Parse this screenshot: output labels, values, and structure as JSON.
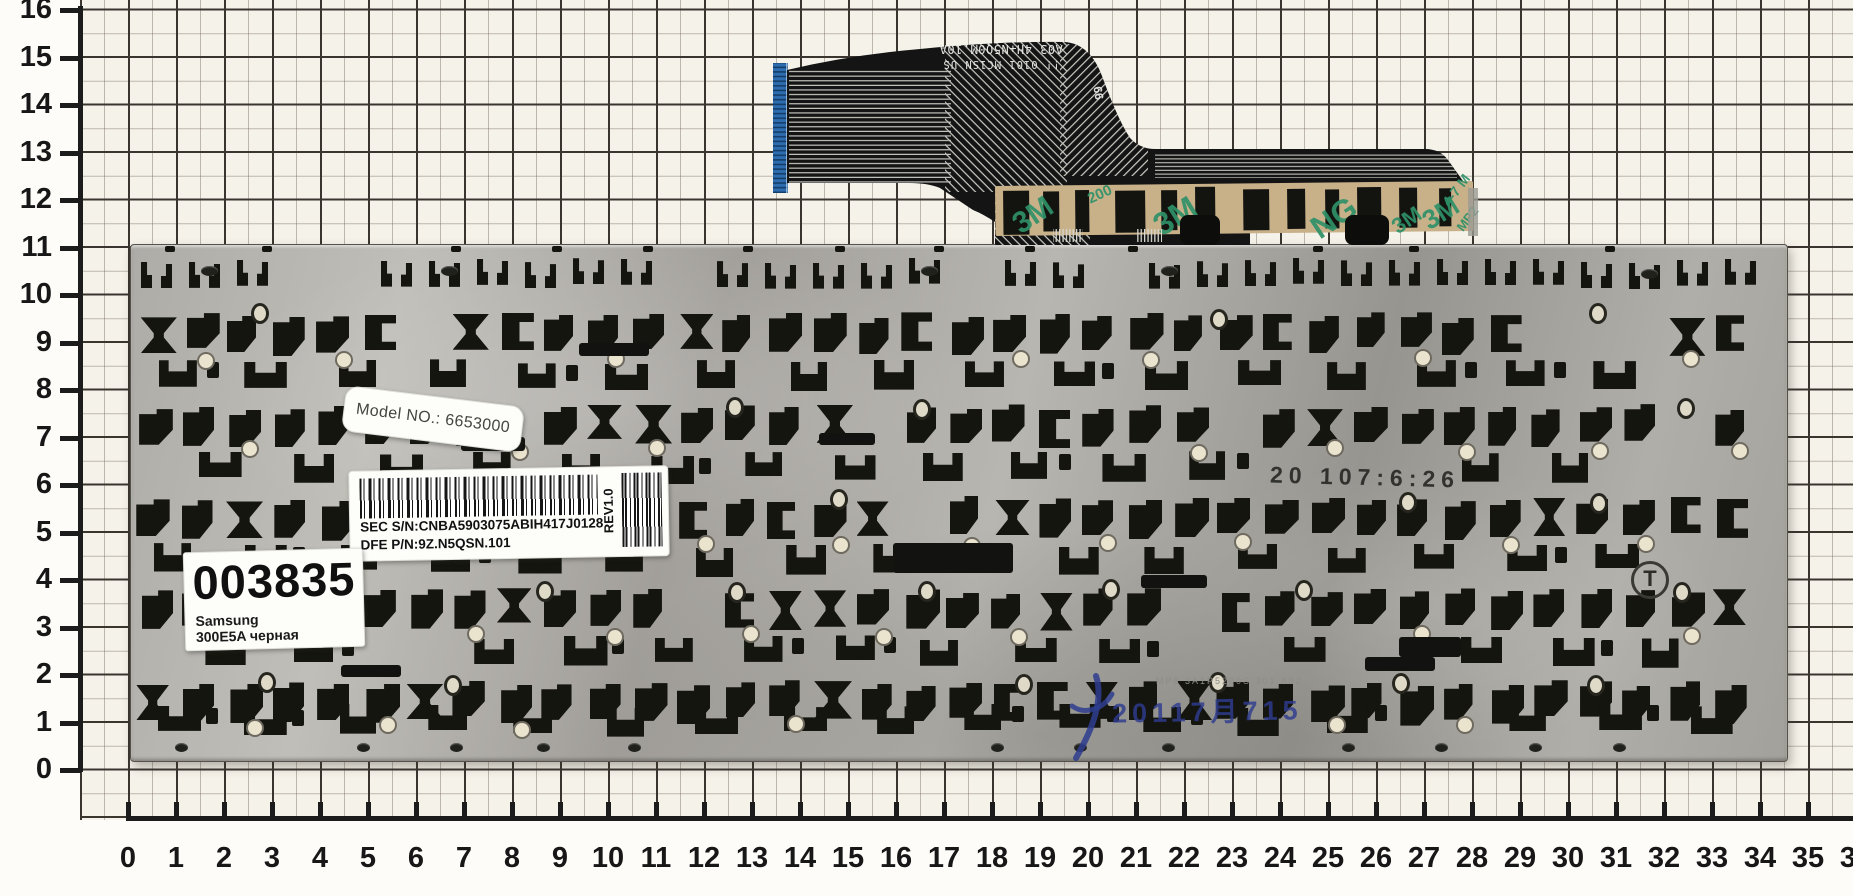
{
  "colors": {
    "paper": "#f5f2ea",
    "grid_bold": "#3b3530",
    "grid_thin": "#6e6458",
    "plate_gray": "#aeaca7",
    "hole_black": "#15150f",
    "cable_black": "#141414",
    "connector_blue": "#2e6cb0",
    "tape_tan": "#c8b089",
    "tape_print_green": "#2f9168",
    "stamp_blue": "#2e3d8f"
  },
  "rulers": {
    "x_labels": [
      "0",
      "1",
      "2",
      "3",
      "4",
      "5",
      "6",
      "7",
      "8",
      "9",
      "10",
      "11",
      "12",
      "13",
      "14",
      "15",
      "16",
      "17",
      "18",
      "19",
      "20",
      "21",
      "22",
      "23",
      "24",
      "25",
      "26",
      "27",
      "28",
      "29",
      "30",
      "31",
      "32",
      "33",
      "34",
      "35",
      "36"
    ],
    "y_labels": [
      "0",
      "1",
      "2",
      "3",
      "4",
      "5",
      "6",
      "7",
      "8",
      "9",
      "10",
      "11",
      "12",
      "13",
      "14",
      "15",
      "16"
    ]
  },
  "stickers": {
    "model_label": "Model NO.: 6653000",
    "barcode_line1": "SEC S/N:CNBA5903075ABIH417J0128",
    "barcode_line2": "DFE P/N:9Z.N5QSN.101",
    "barcode_rev": "REV1.0",
    "id_number": "003835",
    "id_brand": "Samsung",
    "id_model": "300E5A черная"
  },
  "plate_marks": {
    "stamp_black": "20 107:6:26",
    "etch": "MP8 3A1P5200S 301 A02",
    "stamp_blue": "20117月715",
    "boss_mark": "T"
  },
  "cable": {
    "print_line1": "!! 0101   MC1SN   US",
    "print_line2": "A03 4H+N5Q0M.10A",
    "side_mark": "99",
    "tape_marks": [
      "3M",
      "200",
      "3M",
      "NG",
      "3M",
      "4-7 M",
      "MP2",
      "3M"
    ]
  }
}
